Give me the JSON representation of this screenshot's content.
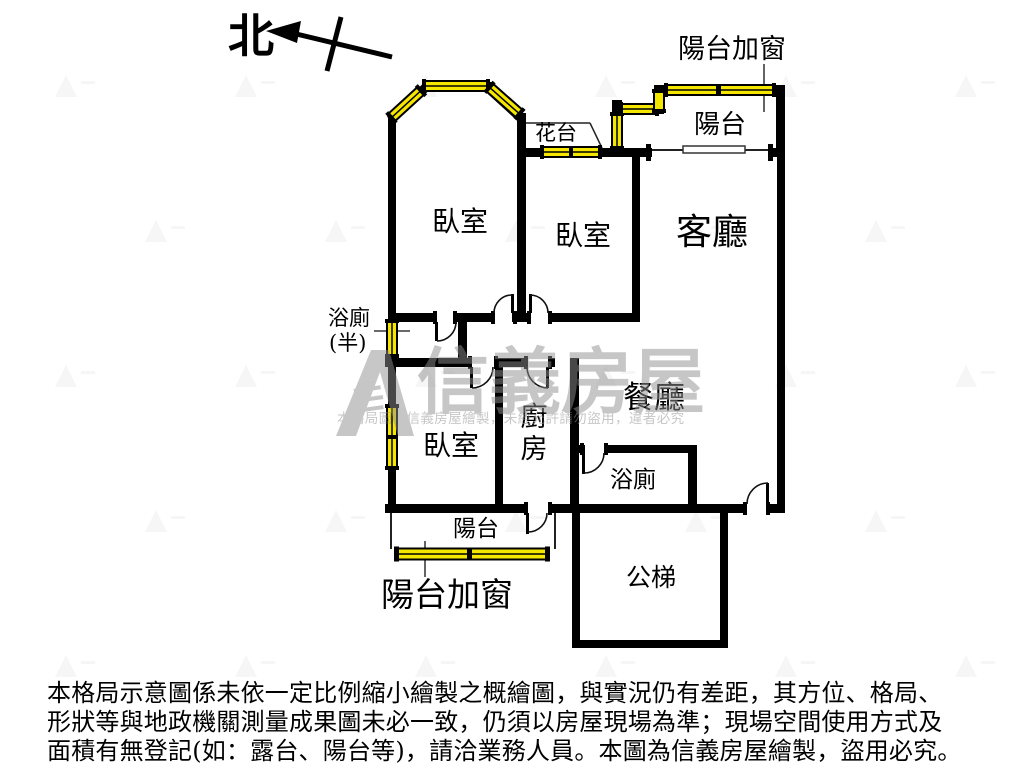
{
  "compass": {
    "label": "北"
  },
  "plan": {
    "rooms": {
      "bedroom_top_left": "臥室",
      "bedroom_top_middle": "臥室",
      "bedroom_bottom": "臥室",
      "living_room": "客廳",
      "dining_room": "餐廳",
      "kitchen_char_top": "廚",
      "kitchen_char_bottom": "房",
      "bathroom": "浴廁",
      "half_bath_line1": "浴廁",
      "half_bath_line2": "(半)",
      "balcony_top": "陽台",
      "balcony_bottom": "陽台",
      "stairs": "公梯",
      "flower_bed": "花台"
    },
    "annotations": {
      "balcony_window_top": "陽台加窗",
      "balcony_window_bottom": "陽台加窗"
    }
  },
  "watermark": {
    "brand": "信義房屋",
    "notice": "本格局圖為信義房屋繪製，未經允許請勿盜用，違者必究"
  },
  "disclaimer": {
    "line1": "本格局示意圖係未依一定比例縮小繪製之概繪圖，與實況仍有差距，其方位、格局、",
    "line2": "形狀等與地政機關測量成果圖未必一致，仍須以房屋現場為準；現場空間使用方式及",
    "line3": "面積有無登記(如：露台、陽台等)，請洽業務人員。本圖為信義房屋繪製，盜用必究。"
  },
  "colors": {
    "wall": "#000000",
    "window_fill": "#f5e600",
    "thin_line": "#222222",
    "watermark_gray": "#8f8f8f",
    "paper": "#ffffff"
  }
}
